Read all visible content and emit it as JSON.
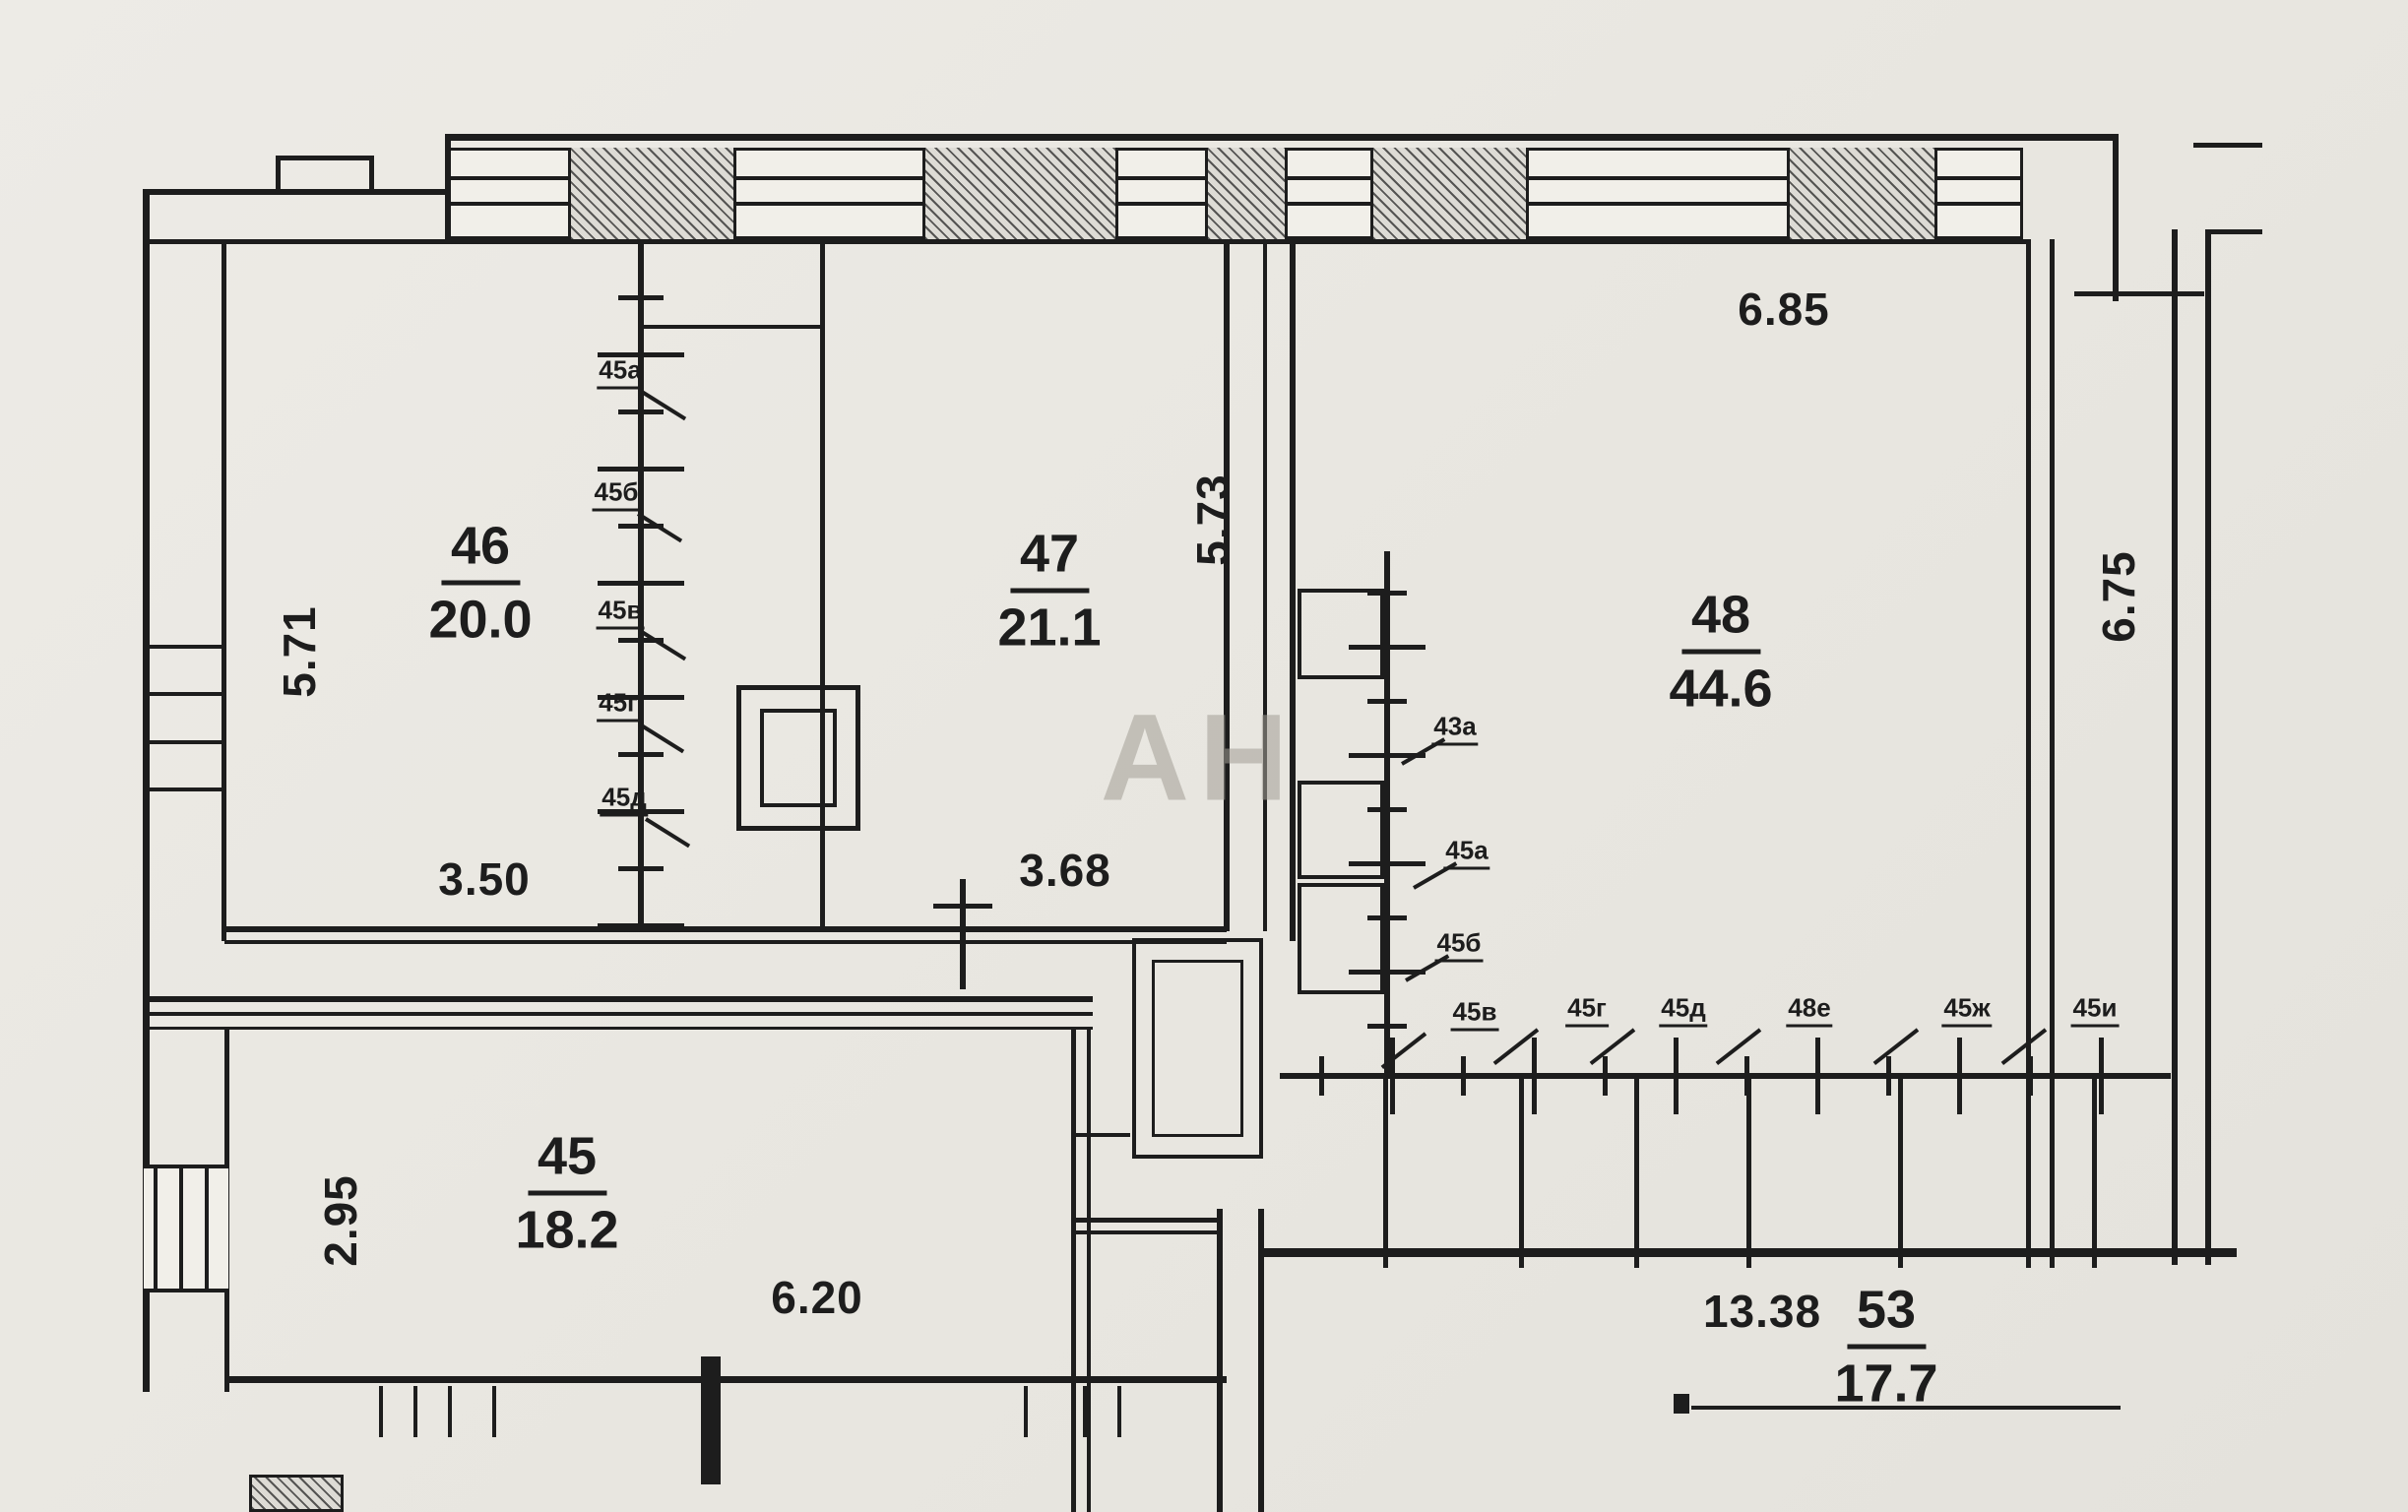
{
  "plan": {
    "watermark": "АН",
    "rooms": {
      "r45": {
        "number": "45",
        "area": "18.2"
      },
      "r46": {
        "number": "46",
        "area": "20.0"
      },
      "r47": {
        "number": "47",
        "area": "21.1"
      },
      "r48": {
        "number": "48",
        "area": "44.6"
      },
      "r53": {
        "number": "53",
        "area": "17.7"
      }
    },
    "dimensions": {
      "left_46": "5.71",
      "bottom_46": "3.50",
      "right_47": "5.73",
      "bottom_47": "3.68",
      "top_48": "6.85",
      "right_48": "6.75",
      "left_45": "2.95",
      "bottom_45": "6.20",
      "bottom_53": "13.38"
    },
    "wall_tags": {
      "left_column": [
        "45а",
        "45б",
        "45в",
        "45г",
        "45д"
      ],
      "middle_column": [
        "43а",
        "45а",
        "45б"
      ],
      "bottom_row": [
        "45в",
        "45г",
        "45д",
        "48е",
        "45ж",
        "45и"
      ]
    },
    "colors": {
      "paper": "#eae8e2",
      "ink": "#1d1d1d",
      "watermark_color": "#a39f96"
    }
  }
}
